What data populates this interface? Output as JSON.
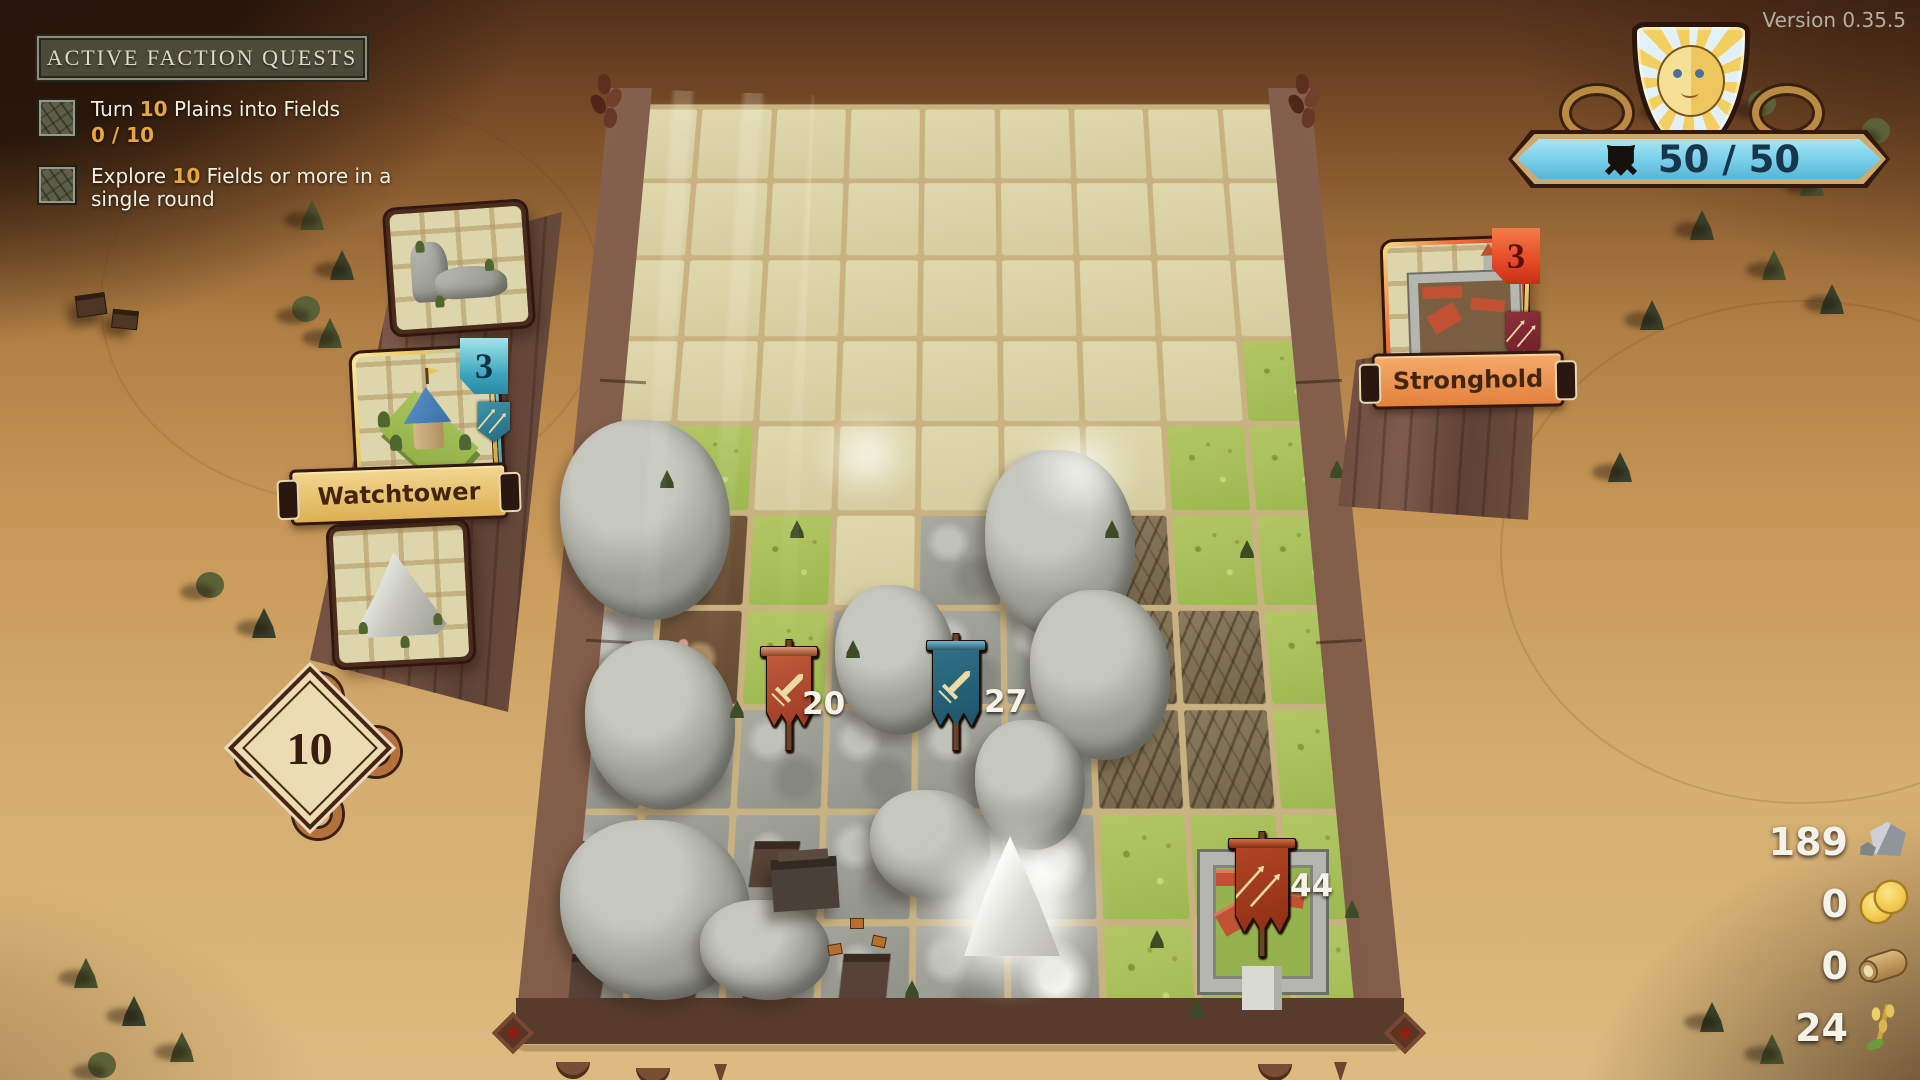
{
  "version_label": "Version 0.35.5",
  "quest_panel": {
    "header": "ACTIVE FACTION QUESTS",
    "quests": [
      {
        "prefix": "Turn ",
        "amount": "10",
        "suffix": " Plains into Fields",
        "progress": "0 / 10"
      },
      {
        "prefix": "Explore ",
        "amount": "10",
        "suffix": " Fields or more in a single round",
        "progress": ""
      }
    ]
  },
  "faction_hud": {
    "emblem": "sun-face-shield",
    "strength": "50 / 50"
  },
  "tile_tray": {
    "cards": [
      {
        "name": "rock-corner-tile",
        "label": "",
        "count": ""
      },
      {
        "name": "watchtower-tile",
        "label": "Watchtower",
        "count": "3"
      },
      {
        "name": "mountain-tile",
        "label": "",
        "count": ""
      }
    ],
    "deck_count": "10"
  },
  "enemy_card": {
    "label": "Stronghold",
    "count": "3"
  },
  "armies": [
    {
      "name": "red-army",
      "value": "20"
    },
    {
      "name": "teal-army",
      "value": "27"
    },
    {
      "name": "stronghold-garrison",
      "value": "44"
    }
  ],
  "resources": [
    {
      "name": "stone",
      "value": "189"
    },
    {
      "name": "gold",
      "value": "0"
    },
    {
      "name": "wood",
      "value": "0"
    },
    {
      "name": "wheat",
      "value": "24"
    }
  ],
  "board": {
    "cols": 9,
    "rows": 10,
    "legend": {
      "e": "plains",
      "g": "field",
      "r": "rocks",
      "m": "mushroom-grove",
      "w": "wastes",
      "t": "rock-settlement",
      "p": "mountain-peak",
      "c": "castle-field"
    },
    "map": [
      "eeeeeeeee",
      "eeeeeeeee",
      "eeeeeeeee",
      "eeeeeeeeg",
      "rgeeeeegg",
      "rmgerrwgg",
      "rmgrrrwwg",
      "rrrrrrwwg",
      "tttrrpgcg",
      "ttttrpgcg"
    ]
  },
  "colors": {
    "accent_orange": "#e7a73e",
    "health_blue": "#7ed3ec",
    "faction_red": "#b5472e",
    "faction_teal": "#2e7187",
    "banner_gold": "#e3b65c",
    "stronghold_orange": "#ef9c57"
  }
}
